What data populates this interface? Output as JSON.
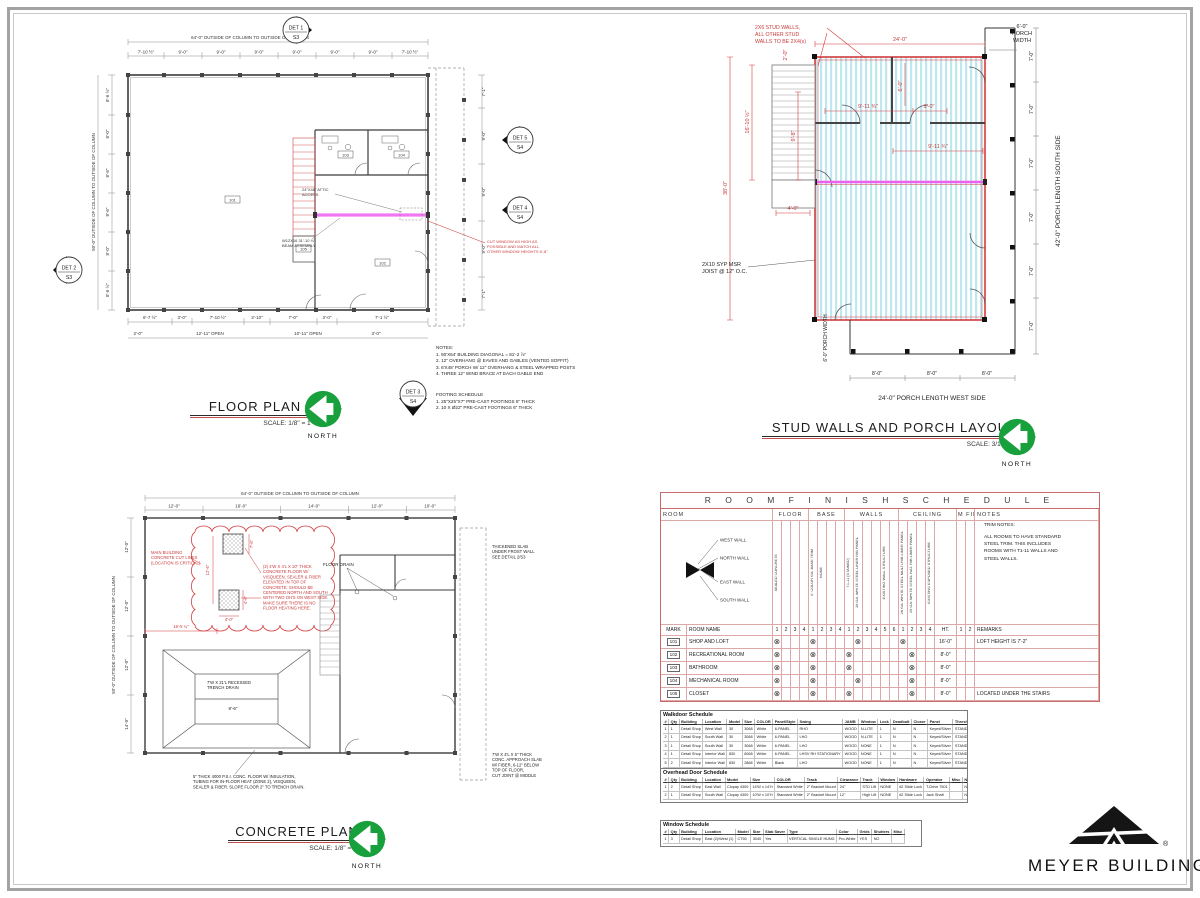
{
  "palette": {
    "dim_red": "#d23c3c",
    "beam_magenta": "#ee5ff0",
    "joist_cyan": "#bfe7f0",
    "north_green": "#18a03c",
    "schedule_pink": "#c96a6a"
  },
  "floor_plan": {
    "title": "FLOOR PLAN",
    "scale": "SCALE:  1/8\" = 1'-0\"",
    "north": "NORTH",
    "dim_top_overall": "64'-0\" OUTSIDE OF COLUMN TO OUTSIDE OF COLUMN",
    "dim_top": [
      "7'-10 ½\"",
      "9'-0\"",
      "9'-0\"",
      "9'-0\"",
      "9'-0\"",
      "9'-0\"",
      "9'-0\"",
      "7'-10 ½\""
    ],
    "dim_left_overall": "50'-0\" OUTSIDE OF COLUMN TO OUTSIDE OF COLUMN",
    "dim_left": [
      "8'-6 ½\"",
      "8'-0\"",
      "8'-6\"",
      "8'-6\"",
      "8'-0\"",
      "8'-6 ½\""
    ],
    "dim_right": [
      "7'-1\"",
      "9'-0\"",
      "9'-0\"",
      "9'-0\"",
      "7'-1\""
    ],
    "dim_bottom": [
      "6'-7 ½\"",
      "3'-0\"",
      "7'-10 ½\"",
      "3'-10\"",
      "7'-0\"",
      "3'-0\"",
      "7'-1 ½\""
    ],
    "dim_bottom2": [
      "2'-0\"",
      "12'-11\" OPEN",
      "10'-11\" OPEN",
      "3'-0\""
    ],
    "attic_note": [
      "24\"X48\" ATTIC",
      "ACCESS"
    ],
    "beam_note": [
      "W12X16 31'-10 ¾\"",
      "BEAM ASSEMBLY"
    ],
    "window_note": [
      "CUT WINDOW AS HIGH AS",
      "POSSIBLE AND MATCH ALL",
      "OTHER WINDOW HEIGHTS 6'-8\""
    ],
    "det_markers": [
      {
        "label": "DET 1",
        "sheet": "S3"
      },
      {
        "label": "DET 2",
        "sheet": "S3"
      },
      {
        "label": "DET 5",
        "sheet": "S4"
      },
      {
        "label": "DET 4",
        "sheet": "S4"
      },
      {
        "label": "DET 3",
        "sheet": "S4"
      }
    ],
    "notes_title": "NOTES:",
    "notes": [
      "1.   50'X64' BUILDING DIAGONAL = 81'-2 ⅞\"",
      "2.   12\" OVERHANG @ EAVES AND GABLES (VENTED SOFFIT)",
      "3.   6'X48' PORCH W/ 12\" OVERHANG & STEEL WRAPPED POSTS",
      "4.   THREE 12\" WIND BRACE AT EACH GABLE END"
    ],
    "footing_title": "FOOTING SCHEDULE",
    "footings": [
      "1.   25\"X25\"X7\" PRE-CAST FOOTINGS 5\" THICK",
      "2.   10 X Ø22\" PRE-CAST FOOTINGS 6\" THICK"
    ]
  },
  "stud_plan": {
    "title": "STUD WALLS AND PORCH LAYOUT",
    "scale": "SCALE:  3/16\" = 1'-0\"",
    "north": "NORTH",
    "red_note": [
      "2X6 STUD WALLS,",
      "ALL OTHER STUD",
      "WALLS TO BE 2X4(s)"
    ],
    "joist_note": [
      "2X10 SYP MSR",
      "JOIST @ 12\" O.C."
    ],
    "dim_top": "24'-0\"",
    "porch_width": [
      "6'-0\"",
      "PORCH",
      "WIDTH"
    ],
    "dim_left": "38'-0\"",
    "dim_stair_h": "16'-10 ½\"",
    "dim_inner_h": "9'-8\"",
    "dim_stair_w": "2'-0\"",
    "dim_room_a": "9'-11 ¾\"",
    "dim_door": "3'-0\"",
    "dim_room_b": "9'-11 ¾\"",
    "dim_room_h": "6'-0\"",
    "dim_door_b": "4'-0\"",
    "porch_seg": "7'-0\"",
    "porch_len_south": "42'-0\" PORCH LENGTH SOUTH SIDE",
    "porch_width_bottom": "6'-0\" PORCH WIDTH",
    "bottom_seg": "8'-0\"",
    "porch_len_west": "24'-0\" PORCH LENGTH WEST SIDE"
  },
  "concrete_plan": {
    "title": "CONCRETE PLAN",
    "scale": "SCALE:  1/8\" = 1'-0\"",
    "north": "NORTH",
    "dim_top_overall": "64'-0\" OUTSIDE OF COLUMN TO OUTSIDE OF COLUMN",
    "dim_top": [
      "12'-0\"",
      "16'-0\"",
      "14'-0\"",
      "12'-0\"",
      "10'-0\""
    ],
    "dim_left_overall": "50'-0\" OUTSIDE OF COLUMN TO OUTSIDE OF COLUMN",
    "dim_left": [
      "12'-0\"",
      "12'-0\"",
      "12'-0\"",
      "14'-0\""
    ],
    "cut_note": [
      "MAIN BUILDING",
      "CONCRETE CUT LINES",
      "(LOCATION IS CRITICAL)"
    ],
    "pads_note": [
      "(2) 4'W X 4'L X 10\" THICK",
      "CONCRETE FLOOR W/",
      "VISQUEEN, SEALER & FIBER",
      "ELEVATED IN TOP OF",
      "CONCRETE. SHOULD BE",
      "CENTERED NORTH AND SOUTH",
      "WITH TWO OH'S ON WEST SIDE.",
      "MAKE SURE THERE IS NO",
      "FLOOR HEATING HERE."
    ],
    "floor_drain": "FLOOR DRAIN",
    "pad_dim_a": "7'-6\"",
    "pad_dim_b": "12'-6\"",
    "pad_dim_w": "4'-0\"",
    "pad_dim_h": "4'-6\"",
    "pad_dim_off": "16'-5 ¼\"",
    "trench_label": [
      "7'W X 21'L RECESSED",
      "TRENCH DRAIN"
    ],
    "trench_dim": "8'-6\"",
    "floor_note": [
      "5\" THICK 4000 P.S.I. CONC. FLOOR W/ INSULATION,",
      "TUBING FOR IN-FLOOR HEAT (ZONE 2), VISQUEEN,",
      "SEALER & FIBER. SLOPE FLOOR 2\" TO TRENCH DRAIN."
    ],
    "thicken_note": [
      "THICKENED SLAB",
      "UNDER FROST WALL",
      "SEE DETAIL 2/S3"
    ],
    "approach_note": [
      "7'W X 4'L X 5\" THICK",
      "CONC. APPROACH SLAB",
      "W/ FIBER, 6-12\" BELOW",
      "TOP OF FLOOR,",
      "CUT JOINT @ MIDDLE"
    ]
  },
  "room_schedule": {
    "title": "R O O M   F I N I S H   S C H E D U L E",
    "col_room": "ROOM",
    "col_floor": "FLOOR",
    "col_base": "BASE",
    "col_walls": "WALLS",
    "col_ceiling": "CEILING",
    "col_rmfin": "RM FIN",
    "col_notes": "NOTES",
    "wall_labels": [
      "WEST WALL",
      "NORTH WALL",
      "EAST WALL",
      "SOUTH WALL"
    ],
    "trim_notes": [
      "TRIM NOTES:",
      "",
      "ALL ROOMS TO HAVE STANDARD",
      "STEEL TRIM. THIS INCLUDES",
      "ROOMS WITH T1-11 WALLS AND",
      "STEEL WALLS."
    ],
    "finish_floor": [
      "SEALED CONCRETE",
      "",
      "",
      ""
    ],
    "finish_base": [
      "4\" COLOR GA. BASE TRIM",
      "NONE",
      "",
      ""
    ],
    "finish_walls": [
      "T1-11 (STAINED)",
      "26 GA. WHITE STEEL LINER RIB PANEL",
      "",
      "",
      "EXISTING WALL STRUCTURE",
      ""
    ],
    "finish_ceiling": [
      "26 GA. WHITE STEEL MULTI-RIB LINER PANEL",
      "29 GA. WHITE STEEL NAT. RIB LINER PANEL",
      "",
      "EXISTING EXPOSED STRUCTURE"
    ],
    "hdr_mark": "MARK",
    "hdr_name": "ROOM NAME",
    "hdr_ht": "HT.",
    "hdr_remarks": "REMARKS",
    "nums_floor": [
      "1",
      "2",
      "3",
      "4"
    ],
    "nums_base": [
      "1",
      "2",
      "3",
      "4"
    ],
    "nums_walls": [
      "1",
      "2",
      "3",
      "4",
      "5",
      "6"
    ],
    "nums_ceiling": [
      "1",
      "2",
      "3",
      "4"
    ],
    "nums_rmfin": [
      "1",
      "2"
    ],
    "check": "⊗",
    "rows": [
      {
        "mark": "101",
        "name": "SHOP AND LOFT",
        "floor": 1,
        "base": 1,
        "walls": 2,
        "ceiling": 1,
        "ht": "16'-0\"",
        "remarks": "LOFT HEIGHT IS 7'-2\""
      },
      {
        "mark": "102",
        "name": "RECREATIONAL ROOM",
        "floor": 1,
        "base": 1,
        "walls": 1,
        "ceiling": 2,
        "ht": "8'-0\"",
        "remarks": ""
      },
      {
        "mark": "103",
        "name": "BATHROOM",
        "floor": 1,
        "base": 1,
        "walls": 1,
        "ceiling": 2,
        "ht": "8'-0\"",
        "remarks": ""
      },
      {
        "mark": "104",
        "name": "MECHANICAL ROOM",
        "floor": 1,
        "base": 1,
        "walls": 2,
        "ceiling": 2,
        "ht": "8'-0\"",
        "remarks": ""
      },
      {
        "mark": "105",
        "name": "CLOSET",
        "floor": 1,
        "base": 1,
        "walls": 1,
        "ceiling": 2,
        "ht": "8'-0\"",
        "remarks": "LOCATED UNDER THE STAIRS"
      }
    ]
  },
  "door_schedules": [
    {
      "title": "Walkdoor Schedule",
      "headers": [
        "#",
        "Qty",
        "Building",
        "Location",
        "Model",
        "Size",
        "COLOR",
        "Panel/Style",
        "Swing",
        "JAMB",
        "Window",
        "Lock",
        "Deadbolt",
        "Closer",
        "Panel",
        "Threshold",
        "Misc"
      ],
      "rows": [
        [
          "1",
          "1",
          "Detail Shop",
          "West Wall",
          "30",
          "3068",
          "White",
          "6-PANEL",
          "RHO",
          "WOOD",
          "N-LITE",
          "1",
          "N",
          "N",
          "Keyed/Silver",
          "STANDARD",
          ""
        ],
        [
          "2",
          "1",
          "Detail Shop",
          "South Wall",
          "30",
          "3068",
          "White",
          "6-PANEL",
          "LHO",
          "WOOD",
          "N-LITE",
          "1",
          "N",
          "N",
          "Keyed/Silver",
          "STANDARD",
          ""
        ],
        [
          "3",
          "1",
          "Detail Shop",
          "South Wall",
          "30",
          "3068",
          "White",
          "6-PANEL",
          "LHO",
          "WOOD",
          "NONE",
          "1",
          "N",
          "N",
          "Keyed/Silver",
          "STANDARD",
          ""
        ],
        [
          "4",
          "1",
          "Detail Shop",
          "Interior Wall",
          "830",
          "6068",
          "White",
          "6-PANEL",
          "LHSV RH STATIONARY",
          "WOOD",
          "NONE",
          "1",
          "N",
          "N",
          "Keyed/Silver",
          "STANDARD",
          ""
        ],
        [
          "5",
          "2",
          "Detail Shop",
          "Interior Wall",
          "830",
          "2868",
          "White",
          "Blank",
          "LHO",
          "WOOD",
          "NONE",
          "1",
          "N",
          "N",
          "Keyed/Silver",
          "STANDARD",
          ""
        ],
        [
          "6",
          "2",
          "Detail Shop",
          "Interior Wall",
          "",
          "2868",
          "White",
          "Blank",
          "RHO",
          "WOOD",
          "NONE",
          "1",
          "N",
          "N",
          "Keyed/Silver",
          "STANDARD",
          ""
        ]
      ]
    },
    {
      "title": "Overhead Door Schedule",
      "headers": [
        "#",
        "Qty",
        "Building",
        "Location",
        "Model",
        "Size",
        "COLOR",
        "Track",
        "Clearance",
        "Track",
        "Window",
        "Hardware",
        "Operator",
        "Misc",
        "Notes"
      ],
      "rows": [
        [
          "1",
          "2",
          "Detail Shop",
          "East Wall",
          "Clopay 4300",
          "14'W x 14'H",
          "Standard White",
          "2\" Bracket Mount",
          "24\"",
          "STD Lift",
          "NONE",
          "#2 Slide Lock",
          "T-Drive 7501",
          "",
          "No"
        ],
        [
          "2",
          "1",
          "Detail Shop",
          "South Wall",
          "Clopay 4300",
          "10'W x 10'H",
          "Standard White",
          "2\" Bracket Mount",
          "12\"",
          "High Lift",
          "NONE",
          "#2 Slide Lock",
          "Jack Shaft",
          "",
          "No"
        ]
      ]
    },
    {
      "title": "Window Schedule",
      "headers": [
        "#",
        "Qty",
        "Building",
        "Location",
        "Model",
        "Size",
        "Slab Saver",
        "Type",
        "Color",
        "Grids",
        "Shutters",
        "Misc"
      ],
      "rows": [
        [
          "1",
          "3",
          "Detail Shop",
          "East (2)/West (1)",
          "CT50",
          "3040",
          "Yes",
          "VERTICAL SINGLE HUNG",
          "Pro-White",
          "YES",
          "NO",
          ""
        ]
      ]
    }
  ],
  "logo": {
    "name": "MEYER BUILDING",
    "reg": "®"
  }
}
